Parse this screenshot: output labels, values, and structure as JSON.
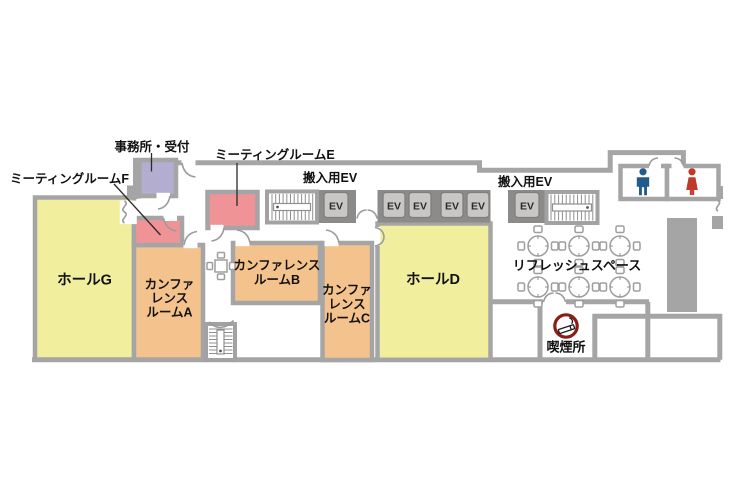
{
  "floor_labels": {
    "office": "事務所・受付",
    "meeting_room_f": "ミーティングルームF",
    "meeting_room_e": "ミーティングルームE",
    "service_elevator_left": "搬入用EV",
    "service_elevator_right": "搬入用EV",
    "hall_g": "ホールG",
    "hall_d": "ホールD",
    "conference_room_a": [
      "カンファ",
      "レンス",
      "ルームA"
    ],
    "conference_room_b": [
      "カンファレンス",
      "ルームB"
    ],
    "conference_room_c": [
      "カンファ",
      "レンス",
      "ルームC"
    ],
    "refresh_space": "リフレッシュスペース",
    "smoking_area": "喫煙所",
    "elevator": "EV"
  },
  "colors": {
    "hall_room": "#f1ee9d",
    "conference_room": "#f4c28d",
    "meeting_room": "#f09396",
    "office_room": "#b3aed0",
    "wall": "#a5a5a5",
    "elevator_band": "#8d8b8a",
    "elevator_car": "#c9c7c5",
    "male_icon": "#235c8c",
    "female_icon": "#bf3a28",
    "smoking_icon": "#8c1c15"
  }
}
